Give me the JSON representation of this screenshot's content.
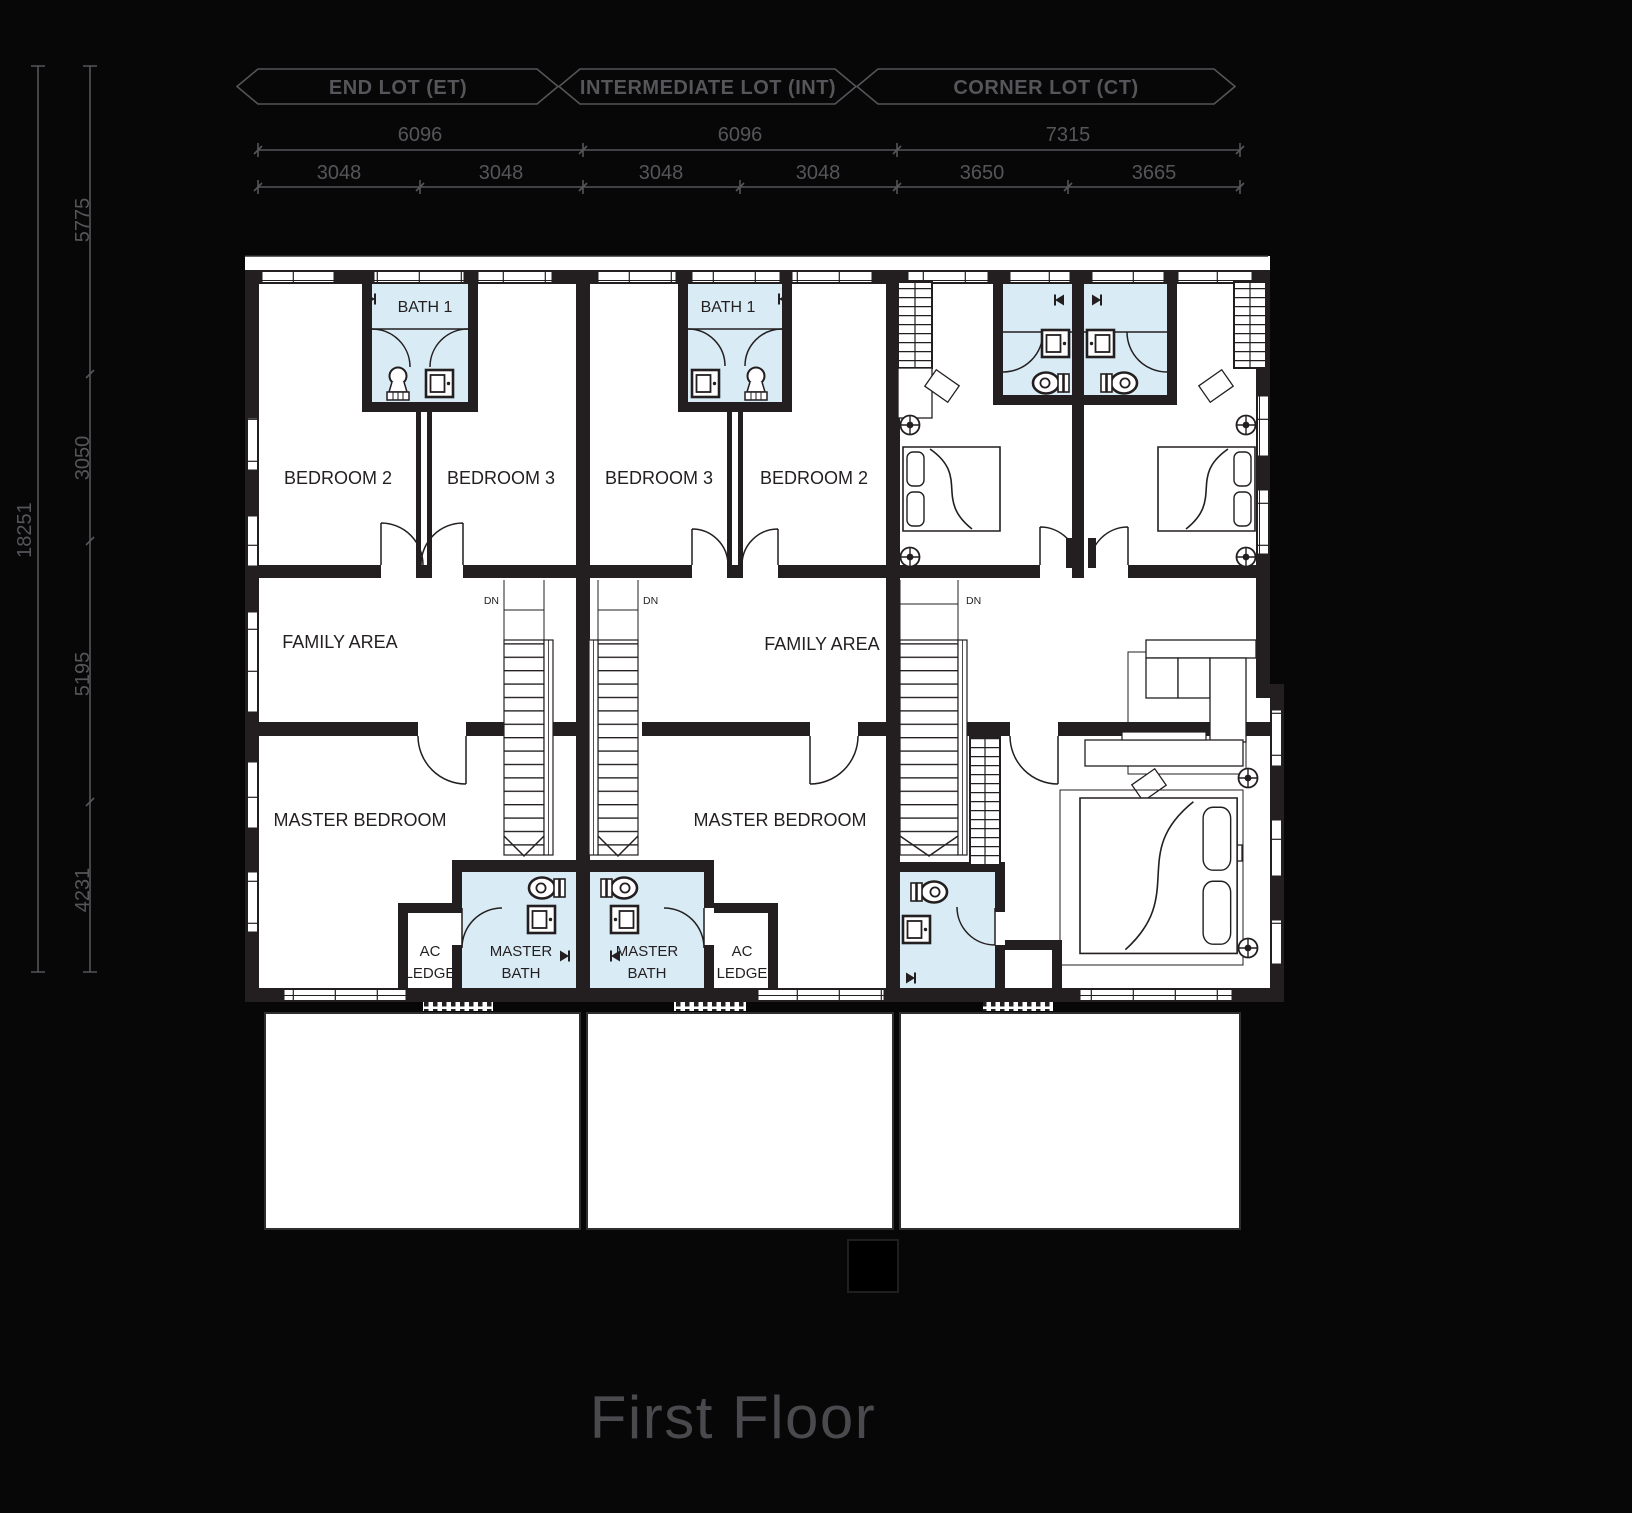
{
  "title": "First Floor",
  "banners": [
    {
      "label": "END LOT (ET)"
    },
    {
      "label": "INTERMEDIATE LOT (INT)"
    },
    {
      "label": "CORNER LOT (CT)"
    }
  ],
  "top_dimensions": {
    "overall": [
      "6096",
      "6096",
      "7315"
    ],
    "segments": [
      "3048",
      "3048",
      "3048",
      "3048",
      "3650",
      "3665"
    ]
  },
  "left_dimensions": {
    "overall": "18251",
    "segments": [
      "5775",
      "3050",
      "5195",
      "4231"
    ]
  },
  "units": {
    "end_lot": {
      "bath1": "BATH 1",
      "bedroom_a": "BEDROOM 2",
      "bedroom_b": "BEDROOM 3",
      "family_area": "FAMILY AREA",
      "stair_note": "DN",
      "master_bedroom": "MASTER BEDROOM",
      "master_bath_1": "MASTER",
      "master_bath_2": "BATH",
      "ac_ledge_1": "AC",
      "ac_ledge_2": "LEDGE"
    },
    "intermediate_lot": {
      "bath1": "BATH 1",
      "bedroom_a": "BEDROOM 3",
      "bedroom_b": "BEDROOM 2",
      "family_area": "FAMILY AREA",
      "stair_note": "DN",
      "master_bedroom": "MASTER BEDROOM",
      "master_bath_1": "MASTER",
      "master_bath_2": "BATH",
      "ac_ledge_1": "AC",
      "ac_ledge_2": "LEDGE"
    },
    "corner_lot": {
      "stair_note": "DN"
    }
  },
  "colors": {
    "background": "#070707",
    "plan_fill": "#ffffff",
    "wall": "#231f20",
    "bath_fill": "#d9ebf5",
    "annotation": "#55555a",
    "title": "#4a4a4e"
  }
}
